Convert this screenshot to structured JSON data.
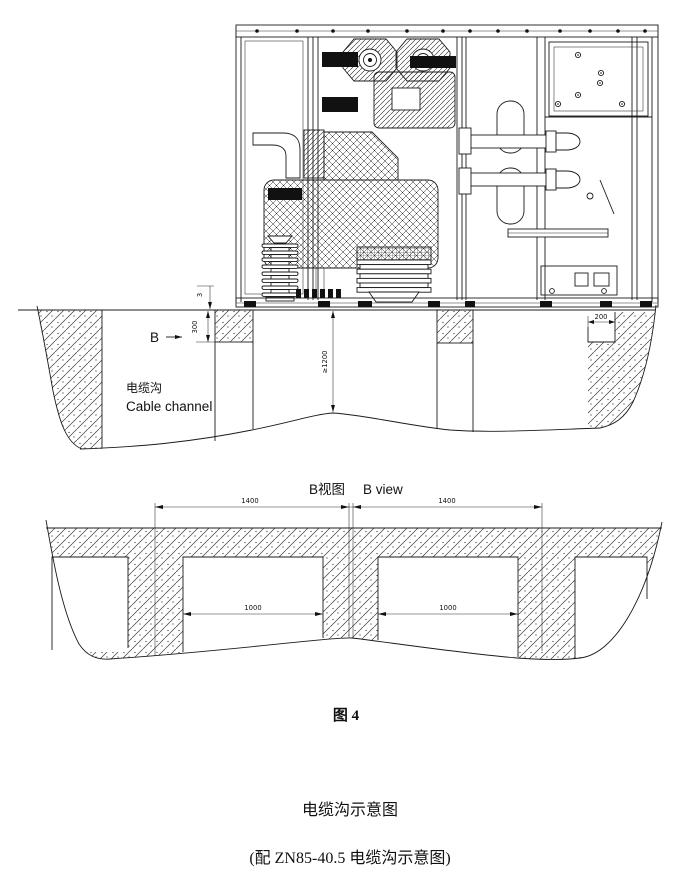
{
  "figure": {
    "elevation": {
      "ground_dim": "3",
      "foundation_depth": "300",
      "edge_dim": "200",
      "channel_depth": "≥1200",
      "section_marker": "B",
      "channel_label_cn": "电缆沟",
      "channel_label_en": "Cable channel"
    },
    "b_view": {
      "title_cn": "B视图",
      "title_en": "B view",
      "panel_width_left": "1400",
      "panel_width_right": "1400",
      "opening_width_left": "1000",
      "opening_width_right": "1000"
    },
    "captions": {
      "figure_no": "图 4",
      "title": "电缆沟示意图",
      "subtitle": "(配 ZN85-40.5  电缆沟示意图)"
    }
  }
}
